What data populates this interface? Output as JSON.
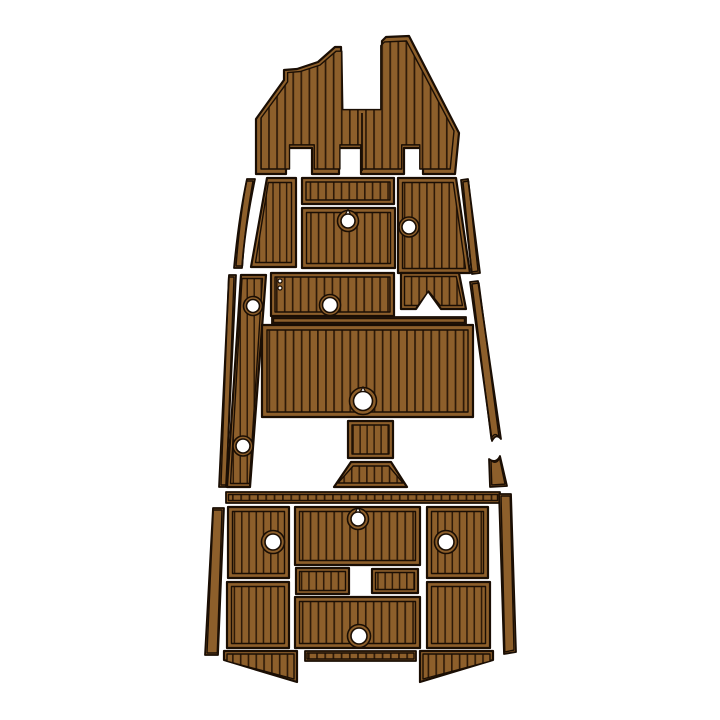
{
  "product_image": {
    "subject": "boat-eva-foam-teak-deck-pad-set",
    "background": "#ffffff"
  },
  "colors": {
    "panel_base": "#8d5f2b",
    "plank_groove": "#2e1a08",
    "outline": "#1a0e04",
    "hole_fill": "#ffffff"
  },
  "plank": {
    "spacing": 8.5,
    "groove_width": 1.8,
    "orientation": "vertical"
  },
  "panels": [
    {
      "name": "bow-deck-pad",
      "inset": 5,
      "shape": {
        "type": "path",
        "d": "M256,174 L256,119 L284,80 L284,70 L297,69 L318,62 L335,47 L341,47 L342,110 L382,110 L382,41 L386,37 L409,36 L459,133 L455,174 L423,174 L423,148 L404,148 L404,174 L361,174 L361,148 L339,148 L339,174 L312,174 L312,148 L286,148 L286,174 Z"
      },
      "seams": [
        [
          362,
          113,
          362,
          171
        ]
      ]
    },
    {
      "name": "port-bow-side-trim",
      "field": "solid",
      "inset": 2,
      "outer_stroke": 1.8,
      "shape": {
        "type": "path",
        "d": "M247,179 L255,179 C249,208 244,238 242,268 L234,268 C237,237 241,207 247,179 Z"
      }
    },
    {
      "name": "port-forward-panel",
      "inset": 4.5,
      "shape": {
        "type": "polygon",
        "points": "267,178 296,178 296,267 251,267"
      }
    },
    {
      "name": "helm-top-panel",
      "inset": 4,
      "shape": {
        "type": "rect",
        "x": 302,
        "y": 178,
        "w": 92,
        "h": 26
      }
    },
    {
      "name": "helm-hatch-panel",
      "inset": 4.5,
      "shape": {
        "type": "rect",
        "x": 302,
        "y": 208,
        "w": 93,
        "h": 60
      },
      "holes": [
        {
          "cx": 348,
          "cy": 221,
          "r": 7,
          "ring": 10.5,
          "tip": "up"
        }
      ]
    },
    {
      "name": "starboard-forward-panel",
      "inset": 4.5,
      "shape": {
        "type": "polygon",
        "points": "398,178 456,178 470,273 398,273"
      },
      "holes": [
        {
          "cx": 409,
          "cy": 227,
          "r": 7,
          "ring": 10
        }
      ]
    },
    {
      "name": "starboard-bow-side-trim",
      "field": "solid",
      "inset": 2,
      "outer_stroke": 1.8,
      "shape": {
        "type": "polygon",
        "points": "461,180 468,179 480,273 472,274"
      }
    },
    {
      "name": "port-gunwale-outer-trim",
      "field": "solid",
      "inset": 2,
      "outer_stroke": 1.8,
      "shape": {
        "type": "polygon",
        "points": "229,275 236,275 226,487 219,487"
      }
    },
    {
      "name": "port-gunwale-step-pad",
      "inset": 3.5,
      "shape": {
        "type": "polygon",
        "points": "241,275 266,275 250,487 227,487"
      },
      "holes": [
        {
          "cx": 253,
          "cy": 306,
          "r": 6.5,
          "ring": 9.5
        },
        {
          "cx": 243,
          "cy": 446,
          "r": 7,
          "ring": 10
        }
      ]
    },
    {
      "name": "mid-hatch-panel",
      "inset": 4,
      "shape": {
        "type": "rect",
        "x": 271,
        "y": 273,
        "w": 123,
        "h": 43
      },
      "holes": [
        {
          "cx": 330,
          "cy": 305,
          "r": 7.5,
          "ring": 10.5
        }
      ],
      "dots": [
        {
          "cx": 280,
          "cy": 281,
          "r": 2
        },
        {
          "cx": 280,
          "cy": 288,
          "r": 2
        }
      ]
    },
    {
      "name": "starboard-step-bracket-pad",
      "inset": 3.5,
      "shape": {
        "type": "polygon",
        "points": "401,273 459,273 466,309 441,309 428,291 416,309 401,309"
      }
    },
    {
      "name": "starboard-gunwale-trim-upper",
      "field": "solid",
      "inset": 2,
      "outer_stroke": 1.8,
      "shape": {
        "type": "path",
        "d": "M470,282 L478,281 L501,439 Q496,433 492,441 Z"
      }
    },
    {
      "name": "starboard-gunwale-trim-lower",
      "field": "solid",
      "inset": 2,
      "outer_stroke": 1.8,
      "shape": {
        "type": "path",
        "d": "M489,459 Q496,464 500,456 L507,486 L490,487 Z"
      }
    },
    {
      "name": "cockpit-divider-trim",
      "field": "solid",
      "inset": 1.5,
      "outer_stroke": 1.8,
      "shape": {
        "type": "rect",
        "x": 272,
        "y": 317,
        "w": 194,
        "h": 7
      }
    },
    {
      "name": "cockpit-sole-panel",
      "inset": 5,
      "shape": {
        "type": "rect",
        "x": 262,
        "y": 325,
        "w": 211,
        "h": 92
      },
      "holes": [
        {
          "cx": 363,
          "cy": 401,
          "r": 9.5,
          "ring": 13.5,
          "tip": "up"
        }
      ]
    },
    {
      "name": "pedestal-riser-panel",
      "inset": 4,
      "shape": {
        "type": "rect",
        "x": 348,
        "y": 421,
        "w": 45,
        "h": 37
      }
    },
    {
      "name": "pedestal-base-pad",
      "inset": 4,
      "shape": {
        "type": "polygon",
        "points": "351,462 391,462 407,487 334,487"
      }
    },
    {
      "name": "stern-divider-trim",
      "inset": 2.5,
      "outer_stroke": 1.8,
      "shape": {
        "type": "rect",
        "x": 226,
        "y": 492,
        "w": 274,
        "h": 11
      }
    },
    {
      "name": "port-stern-side-trim",
      "field": "solid",
      "inset": 2,
      "outer_stroke": 1.8,
      "shape": {
        "type": "polygon",
        "points": "213,508 224,508 218,655 205,655"
      }
    },
    {
      "name": "stern-port-hatch-panel",
      "inset": 4.5,
      "shape": {
        "type": "rect",
        "x": 228,
        "y": 507,
        "w": 61,
        "h": 71
      },
      "holes": [
        {
          "cx": 273,
          "cy": 542,
          "r": 8,
          "ring": 11.5
        }
      ]
    },
    {
      "name": "stern-center-top-panel",
      "inset": 4.5,
      "shape": {
        "type": "rect",
        "x": 295,
        "y": 507,
        "w": 125,
        "h": 58
      },
      "holes": [
        {
          "cx": 358,
          "cy": 519,
          "r": 7,
          "ring": 10.5,
          "tip": "up"
        }
      ]
    },
    {
      "name": "stern-starboard-hatch-panel",
      "inset": 4.5,
      "shape": {
        "type": "rect",
        "x": 427,
        "y": 507,
        "w": 61,
        "h": 71
      },
      "holes": [
        {
          "cx": 446,
          "cy": 542,
          "r": 8,
          "ring": 11.5
        }
      ]
    },
    {
      "name": "starboard-stern-side-trim",
      "field": "solid",
      "inset": 2,
      "outer_stroke": 1.8,
      "shape": {
        "type": "polygon",
        "points": "499,494 511,494 516,652 504,654"
      }
    },
    {
      "name": "stern-mid-port-step",
      "inset": 3.5,
      "shape": {
        "type": "rect",
        "x": 296,
        "y": 568,
        "w": 53,
        "h": 26
      }
    },
    {
      "name": "stern-mid-starboard-step",
      "inset": 3.5,
      "shape": {
        "type": "rect",
        "x": 372,
        "y": 569,
        "w": 46,
        "h": 24
      }
    },
    {
      "name": "stern-port-lower-panel",
      "inset": 4.5,
      "shape": {
        "type": "rect",
        "x": 227,
        "y": 582,
        "w": 62,
        "h": 66
      }
    },
    {
      "name": "stern-center-lower-panel",
      "inset": 4.5,
      "shape": {
        "type": "rect",
        "x": 295,
        "y": 597,
        "w": 125,
        "h": 51
      },
      "holes": [
        {
          "cx": 359,
          "cy": 636,
          "r": 8,
          "ring": 11.5
        }
      ]
    },
    {
      "name": "stern-starboard-lower-panel",
      "inset": 4.5,
      "shape": {
        "type": "rect",
        "x": 427,
        "y": 582,
        "w": 63,
        "h": 66
      }
    },
    {
      "name": "transom-port-wedge",
      "inset": 3,
      "shape": {
        "type": "polygon",
        "points": "224,651 297,651 297,682 224,660"
      }
    },
    {
      "name": "transom-center-trim",
      "inset": 2,
      "outer_stroke": 1.8,
      "shape": {
        "type": "rect",
        "x": 305,
        "y": 651,
        "w": 111,
        "h": 10
      }
    },
    {
      "name": "transom-starboard-wedge",
      "inset": 3,
      "shape": {
        "type": "polygon",
        "points": "420,651 493,651 493,660 420,682"
      }
    }
  ]
}
